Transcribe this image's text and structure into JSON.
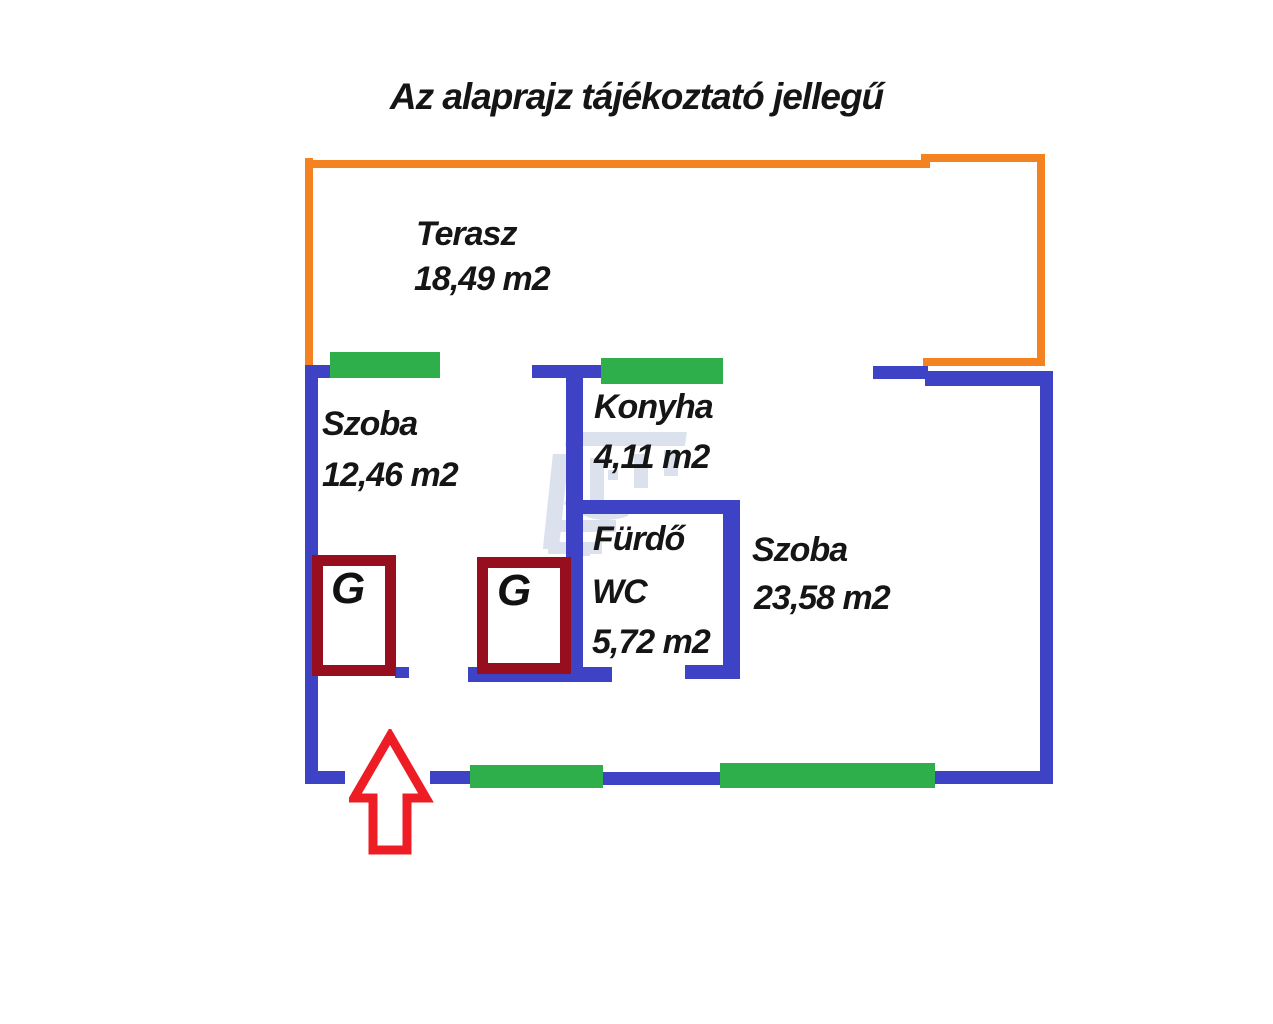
{
  "title": "Az alaprajz tájékoztató jellegű",
  "rooms": [
    {
      "name": "Terasz",
      "area": "18,49 m2"
    },
    {
      "name": "Szoba",
      "area": "12,46 m2"
    },
    {
      "name": "Konyha",
      "area": "4,11 m2"
    },
    {
      "name": "Fürdő",
      "name2": "WC",
      "area": "5,72 m2"
    },
    {
      "name": "Szoba",
      "area": "23,58 m2"
    }
  ],
  "markers": {
    "gas_label": "G"
  },
  "legend_semantics": {
    "blue-walls": "interior/exterior walls",
    "green-segments": "windows",
    "orange-outline": "terrace boundary",
    "red-arrow": "entrance direction"
  },
  "colors": {
    "wall_blue": "#3d43c4",
    "window_green": "#2fae4c",
    "terrace_orange": "#f58220",
    "gas_box_maroon": "#970e1e",
    "entrance_arrow_red": "#ee1c25",
    "text_black": "#151515",
    "background": "#ffffff"
  }
}
